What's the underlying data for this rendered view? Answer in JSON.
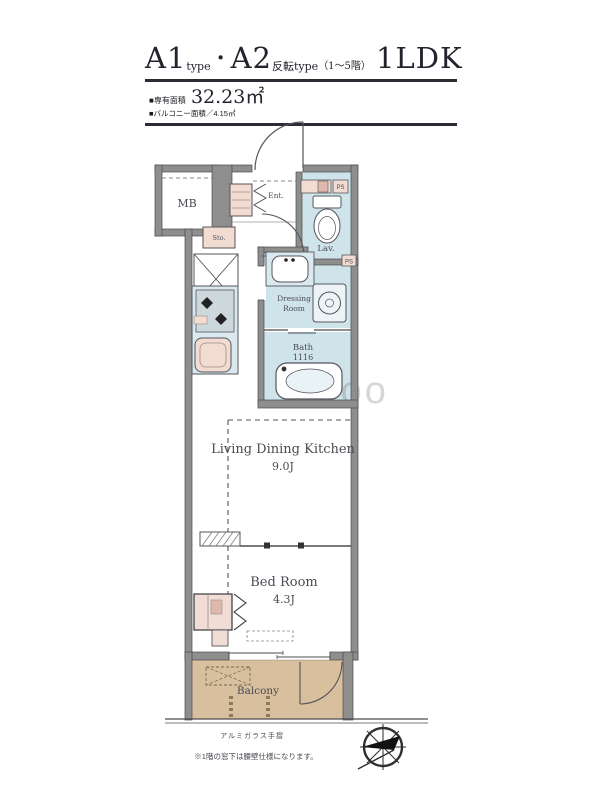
{
  "header": {
    "title": {
      "a1": "A1",
      "a1_sub": "type",
      "dot": "・",
      "a2": "A2",
      "a2_sub": "反転type",
      "floors": "（1～5階）",
      "plan_type": "1LDK"
    },
    "area_label": "■専有面積",
    "area_value": "32.23㎡",
    "balcony_area": "■バルコニー面積／4.15㎡"
  },
  "plan": {
    "mb": "MB",
    "ent": "Ent.",
    "lav": "Lav.",
    "sto": "Sto.",
    "dressing_1": "Dressing",
    "dressing_2": "Room",
    "bath_1": "Bath",
    "bath_2": "1116",
    "ldk_1": "Living Dining Kitchen",
    "ldk_2": "9.0J",
    "bed_1": "Bed Room",
    "bed_2": "4.3J",
    "balcony": "Balcony",
    "ps_lav": "PS",
    "ps_dressing": "PS"
  },
  "footer": {
    "railing": "アルミガラス手摺",
    "note": "※1階の窓下は腰壁仕様になります。"
  },
  "watermark": "looo",
  "colors": {
    "wall": "#8e8e8c",
    "wet_floor": "#cfe4ea",
    "fixture_pink": "#f2dcd2",
    "balcony_floor": "#d8bf9d",
    "line": "#4c4c52",
    "title_ink": "#23232d"
  }
}
